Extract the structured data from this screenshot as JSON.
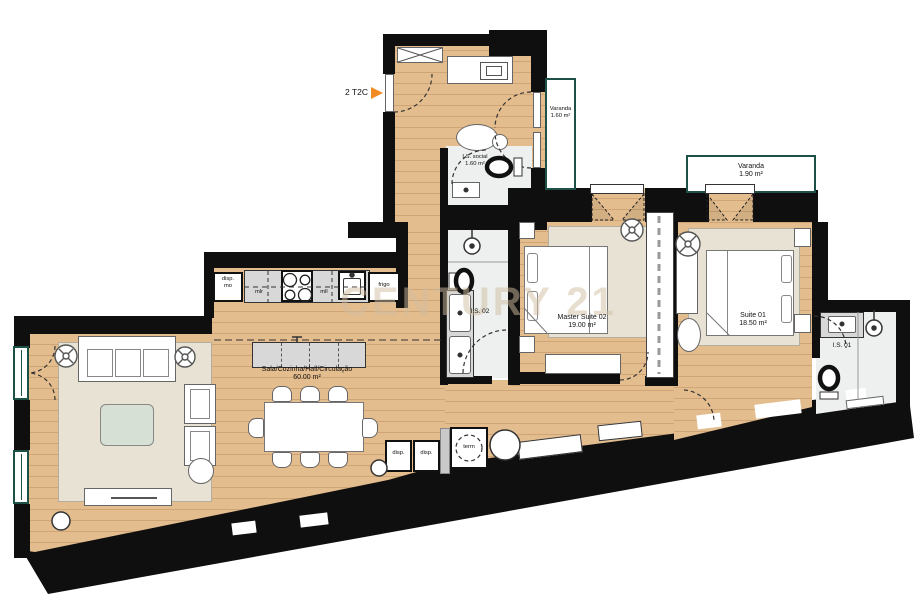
{
  "unit": {
    "label": "2 T2C"
  },
  "watermark": "CENTURY 21",
  "rooms": {
    "sala": {
      "name": "Sala/Cozinha/Hall/Circulação",
      "area": "60.00 m²"
    },
    "master_suite": {
      "name": "Master Suite 02",
      "area": "19.00 m²"
    },
    "suite_01": {
      "name": "Suite 01",
      "area": "18.50 m²"
    },
    "is_social": {
      "name": "I.S. social",
      "area": "1.60 m²"
    },
    "is_02": {
      "name": "I.S. 02"
    },
    "is_01": {
      "name": "I.S. 01"
    },
    "varanda_small": {
      "name": "Varanda",
      "area": "1.60 m²"
    },
    "varanda_large": {
      "name": "Varanda",
      "area": "1.90 m²"
    }
  },
  "kitchen": {
    "pantry_line1": "disp.",
    "pantry_line2": "mo",
    "washer": "mlr",
    "dishwasher": "mll",
    "fridge": "frigo"
  },
  "hallway": {
    "storage_1": "disp.",
    "storage_2": "disp.",
    "water_heater": "term"
  },
  "colors": {
    "wall": "#0f0f0f",
    "wood_floor": "#e3bc8e",
    "entry_arrow_orange": "#f08a21",
    "balcony_outline_green": "#1d5047"
  }
}
